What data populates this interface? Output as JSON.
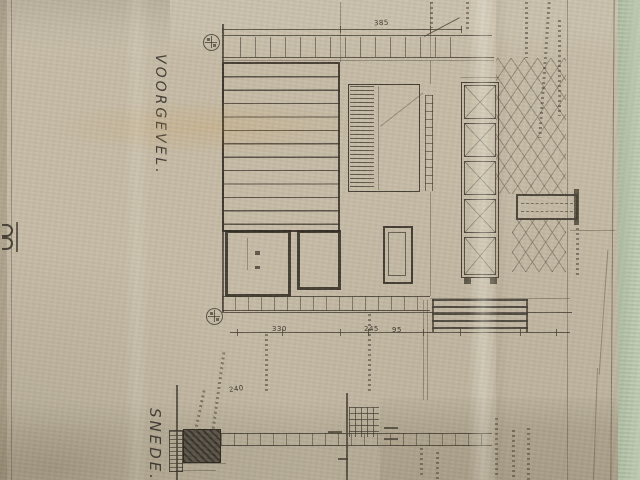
{
  "labels": {
    "front": "VOORGEVEL.",
    "section": "SNEDE."
  },
  "dims": {
    "top": "385",
    "b1": "330",
    "b2": "245",
    "b3": "95",
    "left": "240"
  },
  "colors": {
    "paper": "#c5bba6",
    "ink": "#443e32",
    "table_surface": "#b2c2a6"
  }
}
